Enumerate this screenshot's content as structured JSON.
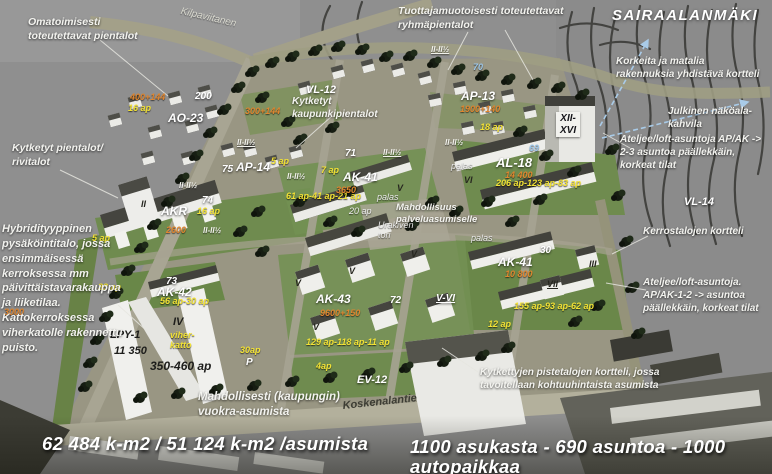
{
  "title": "SAIRAALANMÄKI",
  "callouts": {
    "self_build": "Omatoimisesti toteutettavat pientalot",
    "producer_group": "Tuottajamuotoisesti toteutettavat ryhmäpientalot",
    "high_low_block": "Korkeita ja matalia rakennuksia yhdistävä kortteli",
    "view_cafe": "Julkinen näköala-kahvila",
    "atelier_loft_1": "Ateljee/loft-asuntoja AP/AK -> 2-3 asuntoa päällekkäin, korkeat tilat",
    "apartment_blocks": "Kerrostalojen kortteli",
    "atelier_loft_2": "Ateljee/loft-asuntoja. AP/AK-1-2 -> asuntoa päällekkäin, korkeat tilat",
    "linked_houses": "Kytketyt pientalot/ rivitalot",
    "hybrid_parking": "Hybridityyppinen pysäköintitalo, jossa ensimmäisessä kerroksessa mm päivittäistavarakauppa ja liiketilaa. Kattokerroksessa viherkatolle rakennettu puisto.",
    "linked_townhouses": "Kytketyt kaupunkipientalot",
    "rental_housing": "Mahdollisesti (kaupungin) vuokra-asumista",
    "point_blocks": "Kytkettyjen pistetalojen kortteli, jossa tavoitellaan kohtuuhintaista asumista",
    "service_housing": "Mahdollisuus palveluasumiselle"
  },
  "streets": {
    "top": "Kilpaviitanen",
    "bottom": "Koskenalantie"
  },
  "stats": {
    "floor_area": "62 484 k-m2 / 51 124 k-m2 /asumista",
    "summary": "1100 asukasta - 690 asuntoa - 1000 autopaikkaa"
  },
  "map": {
    "white": [
      "VL-12",
      "AO-23",
      "200",
      "AP-14",
      "75",
      "AP-13",
      "AL-18",
      "AK-41",
      "AK-41",
      "AKR",
      "AK-42",
      "AK-43",
      "EV-12",
      "73",
      "74",
      "71",
      "72",
      "30",
      "P",
      "VL-14",
      "V-VI"
    ],
    "dark": [
      "LPY-1",
      "11 350",
      "350-460 ap",
      "IV",
      "XII-\nXVI"
    ],
    "yellow": [
      "16 ap",
      "5 ap",
      "7 ap",
      "61 ap-41 ap-21 ap",
      "18 ap",
      "206 ap-123 ap-83 ap",
      "16 ap",
      "5 ap",
      "33 ap",
      "56 ap-30 ap",
      "155 ap-93 ap-62 ap",
      "12 ap",
      "129 ap-118 ap-11 ap",
      "30ap",
      "4ap",
      "viher-\nkatto"
    ],
    "orange": [
      "400+144",
      "300+144",
      "1900+140",
      "14 400",
      "3650",
      "2600",
      "10 800",
      "9600+150",
      "3000"
    ],
    "blue": [
      "70",
      "69"
    ],
    "roman": [
      "II",
      "V",
      "V",
      "V",
      "V",
      "VI",
      "VII",
      "III",
      "V"
    ],
    "floors": [
      "II-II½",
      "II-II½",
      "II-II½",
      "II-II½",
      "II-II½",
      "II-II½",
      "II-II½"
    ],
    "italic": [
      "palas",
      "palas",
      "palas",
      "Urakiven\ntori",
      "20 ap"
    ]
  },
  "colors": {
    "label_yellow": "#f2e235",
    "label_orange": "#e0862f",
    "label_blue": "#9cc6e8",
    "lawn_green": "#6f8b4f",
    "road_olive": "#a8a593",
    "building_white": "#eeeeea",
    "callout_white": "#f3f3ef"
  }
}
